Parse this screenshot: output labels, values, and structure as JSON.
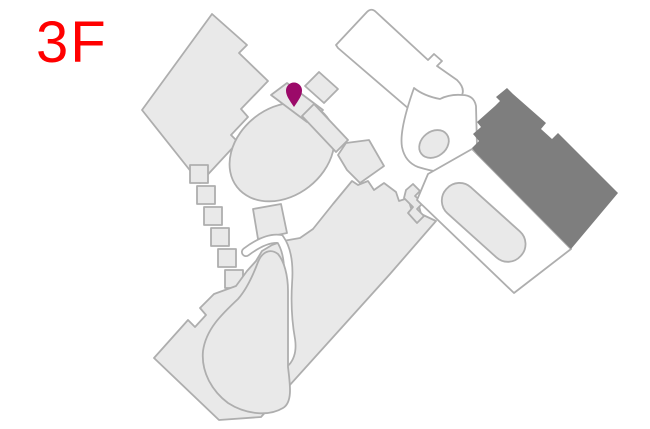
{
  "floor_label": "3F",
  "colors": {
    "background": "#ffffff",
    "floor_label": "#ff0000",
    "building_fill": "#e9e9e9",
    "building_stroke": "#aeaeae",
    "highlight_fill": "#7e7e7e",
    "pin": "#9b0a69"
  },
  "map": {
    "pin": {
      "x": 294,
      "y": 91
    }
  }
}
